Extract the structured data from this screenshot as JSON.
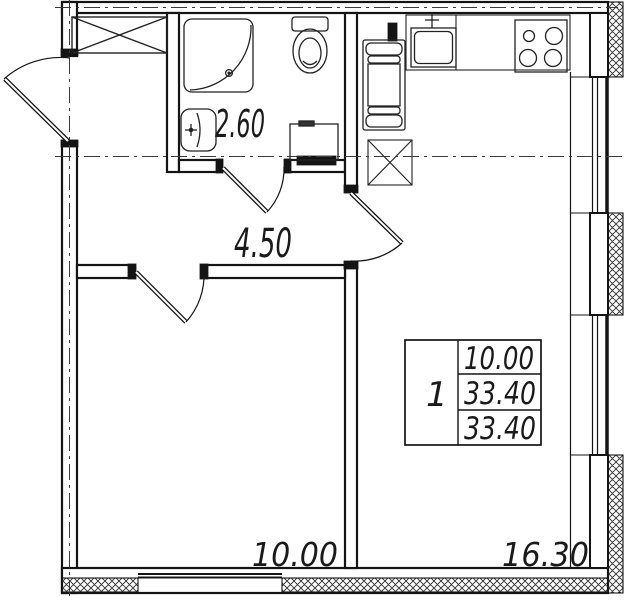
{
  "plan": {
    "labels": {
      "bathroom_area": "2.60",
      "hallway_area": "4.50",
      "room_area": "10.00",
      "kitchen_living_area": "16.30"
    },
    "spec_table": {
      "rooms_count": "1",
      "row1": "10.00",
      "row2": "33.40",
      "row3": "33.40"
    },
    "colors": {
      "line": "#141414",
      "background": "#ffffff"
    }
  }
}
